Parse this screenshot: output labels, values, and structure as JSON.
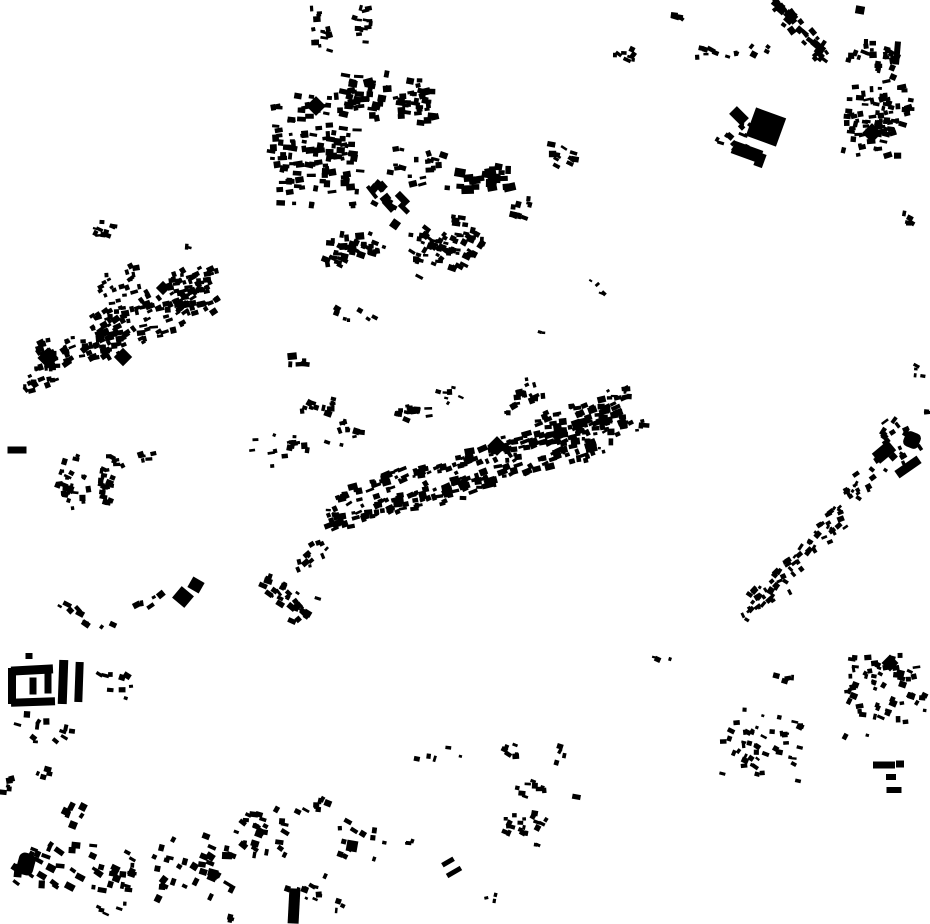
{
  "map": {
    "description": "figure-ground building footprint map, black buildings on white",
    "background": "#ffffff",
    "building_color": "#000000",
    "canvas": {
      "width": 930,
      "height": 924
    },
    "cluster_fields": [
      "cx",
      "cy",
      "rx",
      "ry",
      "band_angle_deg",
      "count",
      "bldg_w",
      "bldg_h",
      "bldg_rot_deg",
      "rot_jitter_deg",
      "seed"
    ],
    "clusters": [
      [
        316,
        150,
        45,
        62,
        0,
        120,
        6.5,
        5,
        0,
        24,
        1
      ],
      [
        390,
        100,
        48,
        26,
        8,
        70,
        7,
        5.5,
        0,
        30,
        2
      ],
      [
        352,
        252,
        36,
        22,
        -10,
        40,
        6.5,
        5,
        10,
        40,
        3
      ],
      [
        388,
        207,
        26,
        20,
        40,
        13,
        11,
        7,
        40,
        30,
        4
      ],
      [
        446,
        246,
        36,
        30,
        -20,
        75,
        6,
        4.5,
        20,
        40,
        5
      ],
      [
        487,
        180,
        28,
        16,
        0,
        22,
        9,
        6,
        0,
        30,
        6
      ],
      [
        420,
        168,
        30,
        24,
        0,
        20,
        6,
        4.5,
        0,
        40,
        7
      ],
      [
        563,
        155,
        12,
        16,
        0,
        11,
        6,
        4.5,
        20,
        40,
        8
      ],
      [
        520,
        210,
        10,
        15,
        0,
        10,
        5.5,
        4.5,
        10,
        40,
        9
      ],
      [
        320,
        30,
        10,
        26,
        0,
        16,
        5.5,
        4,
        0,
        40,
        10
      ],
      [
        362,
        25,
        9,
        26,
        0,
        14,
        5.5,
        4,
        0,
        40,
        11
      ],
      [
        625,
        55,
        16,
        10,
        0,
        8,
        5.5,
        4.5,
        20,
        40,
        12
      ],
      [
        683,
        15,
        10,
        8,
        0,
        5,
        5.5,
        4.5,
        20,
        40,
        13
      ],
      [
        718,
        52,
        22,
        8,
        0,
        9,
        6,
        4.5,
        10,
        40,
        14
      ],
      [
        760,
        50,
        10,
        6,
        0,
        4,
        6,
        4.5,
        30,
        30,
        15
      ],
      [
        800,
        28,
        40,
        12,
        50,
        38,
        6.5,
        5,
        45,
        25,
        16
      ],
      [
        872,
        58,
        26,
        22,
        10,
        26,
        6,
        4.5,
        10,
        40,
        17
      ],
      [
        878,
        118,
        32,
        42,
        5,
        85,
        6,
        4.5,
        0,
        35,
        18
      ],
      [
        733,
        140,
        16,
        26,
        10,
        12,
        5.5,
        4.5,
        30,
        40,
        19
      ],
      [
        906,
        222,
        6,
        12,
        0,
        5,
        5,
        4,
        20,
        40,
        20
      ],
      [
        919,
        371,
        5,
        9,
        0,
        4,
        4.5,
        3.5,
        20,
        40,
        21
      ],
      [
        927,
        412,
        3,
        4,
        0,
        2,
        5,
        4,
        0,
        30,
        22
      ],
      [
        890,
        444,
        22,
        26,
        -45,
        24,
        5.5,
        4.5,
        -40,
        40,
        23
      ],
      [
        860,
        483,
        18,
        16,
        -40,
        16,
        5,
        4,
        -40,
        40,
        24
      ],
      [
        830,
        520,
        20,
        18,
        -40,
        22,
        5,
        4,
        -40,
        40,
        25
      ],
      [
        800,
        556,
        20,
        14,
        -40,
        18,
        5,
        4,
        -40,
        40,
        26
      ],
      [
        772,
        588,
        22,
        16,
        -40,
        24,
        5,
        4.5,
        -40,
        40,
        27
      ],
      [
        750,
        610,
        12,
        9,
        -40,
        8,
        5,
        4,
        -40,
        40,
        28
      ],
      [
        155,
        312,
        64,
        30,
        -22,
        150,
        6,
        4.5,
        -20,
        35,
        29
      ],
      [
        72,
        352,
        40,
        22,
        -20,
        50,
        6,
        4.5,
        -20,
        40,
        30
      ],
      [
        40,
        378,
        26,
        14,
        -25,
        16,
        5.5,
        4.5,
        -20,
        40,
        31
      ],
      [
        192,
        278,
        26,
        12,
        -20,
        22,
        6,
        4.5,
        -20,
        40,
        32
      ],
      [
        120,
        285,
        22,
        16,
        -20,
        18,
        5,
        4,
        -20,
        40,
        33
      ],
      [
        103,
        228,
        11,
        14,
        0,
        11,
        5,
        4,
        10,
        40,
        34
      ],
      [
        188,
        247,
        4,
        4,
        0,
        2,
        5,
        4,
        0,
        30,
        35
      ],
      [
        298,
        366,
        8,
        18,
        0,
        5,
        7,
        5,
        0,
        30,
        36
      ],
      [
        352,
        310,
        28,
        16,
        20,
        7,
        5,
        4,
        20,
        40,
        37
      ],
      [
        85,
        483,
        30,
        32,
        0,
        52,
        5.5,
        4.5,
        10,
        40,
        38
      ],
      [
        140,
        455,
        26,
        8,
        -18,
        8,
        5,
        4,
        -10,
        40,
        39
      ],
      [
        280,
        448,
        28,
        18,
        -10,
        16,
        5.5,
        4.5,
        0,
        45,
        40
      ],
      [
        318,
        408,
        16,
        14,
        0,
        12,
        5.5,
        4.5,
        10,
        45,
        41
      ],
      [
        412,
        410,
        18,
        16,
        0,
        16,
        5.5,
        4.5,
        10,
        45,
        42
      ],
      [
        448,
        395,
        16,
        10,
        0,
        7,
        5,
        4,
        10,
        45,
        43
      ],
      [
        478,
        456,
        148,
        9,
        -16,
        105,
        7,
        4.5,
        -16,
        20,
        44
      ],
      [
        462,
        486,
        140,
        11,
        -16,
        115,
        7,
        5,
        -16,
        20,
        45
      ],
      [
        470,
        472,
        150,
        28,
        -16,
        55,
        5,
        4,
        -16,
        40,
        46
      ],
      [
        582,
        424,
        46,
        26,
        -14,
        75,
        6.5,
        5,
        -14,
        30,
        47
      ],
      [
        636,
        420,
        14,
        12,
        -14,
        7,
        5.5,
        4.5,
        -14,
        40,
        48
      ],
      [
        312,
        556,
        20,
        14,
        -30,
        12,
        5.5,
        4.5,
        -30,
        40,
        49
      ],
      [
        288,
        598,
        28,
        22,
        35,
        30,
        6,
        4.5,
        35,
        40,
        50
      ],
      [
        597,
        291,
        12,
        8,
        30,
        4,
        4.5,
        3.5,
        30,
        40,
        51
      ],
      [
        538,
        332,
        6,
        5,
        0,
        2,
        4,
        3.5,
        0,
        40,
        52
      ],
      [
        662,
        660,
        8,
        5,
        0,
        3,
        4.5,
        4,
        10,
        30,
        53
      ],
      [
        80,
        622,
        32,
        18,
        35,
        9,
        6,
        4.5,
        35,
        40,
        54
      ],
      [
        150,
        601,
        16,
        7,
        -20,
        5,
        5.5,
        4.5,
        -20,
        40,
        55
      ],
      [
        45,
        732,
        30,
        16,
        20,
        12,
        5.5,
        4.5,
        20,
        45,
        56
      ],
      [
        115,
        680,
        18,
        24,
        10,
        9,
        5.5,
        4.5,
        15,
        45,
        57
      ],
      [
        8,
        780,
        7,
        18,
        0,
        5,
        5.5,
        5,
        0,
        40,
        58
      ],
      [
        46,
        774,
        12,
        7,
        0,
        4,
        5.5,
        4.5,
        20,
        30,
        59
      ],
      [
        76,
        812,
        12,
        18,
        30,
        6,
        5.5,
        6.5,
        30,
        25,
        60
      ],
      [
        48,
        868,
        33,
        29,
        0,
        26,
        7,
        5.5,
        20,
        35,
        61
      ],
      [
        115,
        870,
        23,
        28,
        0,
        22,
        6.5,
        5,
        20,
        35,
        62
      ],
      [
        193,
        866,
        39,
        36,
        0,
        34,
        7,
        5.5,
        20,
        35,
        63
      ],
      [
        112,
        912,
        20,
        9,
        0,
        5,
        5.5,
        4.5,
        20,
        35,
        64
      ],
      [
        262,
        828,
        26,
        38,
        0,
        28,
        6,
        4.5,
        20,
        40,
        65
      ],
      [
        302,
        888,
        24,
        24,
        0,
        12,
        5.5,
        4.5,
        15,
        40,
        66
      ],
      [
        312,
        806,
        17,
        14,
        0,
        9,
        5.5,
        4.5,
        15,
        40,
        67
      ],
      [
        362,
        840,
        24,
        24,
        0,
        13,
        5.5,
        4.5,
        15,
        40,
        68
      ],
      [
        340,
        906,
        6,
        10,
        0,
        3,
        4.5,
        4,
        20,
        30,
        69
      ],
      [
        440,
        753,
        24,
        8,
        0,
        5,
        5,
        4.5,
        10,
        40,
        70
      ],
      [
        405,
        840,
        10,
        6,
        0,
        3,
        4.5,
        4,
        10,
        30,
        71
      ],
      [
        528,
        828,
        26,
        20,
        10,
        22,
        5.5,
        4.5,
        15,
        40,
        72
      ],
      [
        532,
        786,
        15,
        15,
        0,
        9,
        5.5,
        4.5,
        15,
        40,
        73
      ],
      [
        505,
        752,
        12,
        16,
        0,
        6,
        5,
        4.5,
        15,
        40,
        74
      ],
      [
        566,
        754,
        10,
        10,
        0,
        4,
        6,
        4.5,
        15,
        30,
        75
      ],
      [
        577,
        800,
        5,
        4,
        0,
        1,
        8,
        6,
        15,
        10,
        76
      ],
      [
        492,
        899,
        8,
        5,
        0,
        3,
        4,
        3.5,
        0,
        30,
        77
      ],
      [
        222,
        918,
        10,
        4,
        0,
        3,
        5,
        4,
        20,
        30,
        78
      ],
      [
        762,
        742,
        40,
        46,
        0,
        48,
        5,
        4,
        15,
        45,
        79
      ],
      [
        788,
        678,
        14,
        8,
        0,
        5,
        5,
        4,
        10,
        40,
        80
      ],
      [
        885,
        688,
        40,
        50,
        0,
        60,
        5.5,
        4.5,
        10,
        45,
        81
      ],
      [
        522,
        400,
        22,
        20,
        -14,
        20,
        5.5,
        4.5,
        -14,
        40,
        82
      ],
      [
        345,
        432,
        18,
        16,
        0,
        10,
        5.5,
        4.5,
        0,
        45,
        83
      ],
      [
        618,
        392,
        14,
        10,
        -14,
        8,
        5,
        4,
        -14,
        40,
        84
      ]
    ],
    "special_fields": [
      "cx",
      "cy",
      "w",
      "h",
      "rot_deg",
      "corner_radius"
    ],
    "special_buildings": [
      [
        316,
        106,
        14,
        14,
        45,
        0
      ],
      [
        766,
        127,
        32,
        30,
        20,
        0
      ],
      [
        747,
        152,
        30,
        13,
        20,
        0
      ],
      [
        760,
        160,
        9,
        14,
        20,
        0
      ],
      [
        739,
        116,
        17,
        11,
        45,
        0
      ],
      [
        897,
        53,
        6,
        23,
        5,
        0
      ],
      [
        860,
        10,
        9,
        8,
        10,
        0
      ],
      [
        872,
        133,
        14,
        14,
        45,
        0
      ],
      [
        48,
        358,
        15,
        15,
        45,
        0
      ],
      [
        123,
        357,
        13,
        13,
        45,
        0
      ],
      [
        163,
        288,
        10,
        10,
        45,
        0
      ],
      [
        17,
        450,
        19,
        7,
        0,
        0
      ],
      [
        497,
        446,
        14,
        14,
        45,
        0
      ],
      [
        884,
        452,
        21,
        13,
        -40,
        0
      ],
      [
        912,
        440,
        16,
        16,
        22,
        5
      ],
      [
        908,
        467,
        27,
        9,
        -35,
        0
      ],
      [
        183,
        597,
        16,
        15,
        40,
        0
      ],
      [
        196,
        585,
        13,
        12,
        30,
        0
      ],
      [
        12,
        686,
        8,
        36,
        0,
        0
      ],
      [
        32,
        670,
        42,
        9,
        -3,
        0
      ],
      [
        33,
        702,
        44,
        8,
        -2,
        0
      ],
      [
        33,
        686,
        7,
        17,
        0,
        0
      ],
      [
        48,
        683,
        7,
        21,
        0,
        0
      ],
      [
        63,
        682,
        9,
        44,
        2,
        0
      ],
      [
        79,
        682,
        8,
        40,
        2,
        0
      ],
      [
        29,
        656,
        7,
        6,
        0,
        0
      ],
      [
        26,
        864,
        17,
        22,
        15,
        6
      ],
      [
        294,
        906,
        11,
        35,
        3,
        0
      ],
      [
        352,
        846,
        11,
        11,
        10,
        0
      ],
      [
        448,
        862,
        13,
        5,
        -30,
        0
      ],
      [
        454,
        872,
        16,
        5,
        -30,
        0
      ],
      [
        890,
        663,
        12,
        12,
        45,
        0
      ],
      [
        884,
        765,
        22,
        7,
        0,
        0
      ],
      [
        900,
        764,
        8,
        7,
        0,
        0
      ],
      [
        891,
        777,
        10,
        6,
        0,
        0
      ],
      [
        894,
        790,
        15,
        6,
        0,
        0
      ]
    ]
  }
}
